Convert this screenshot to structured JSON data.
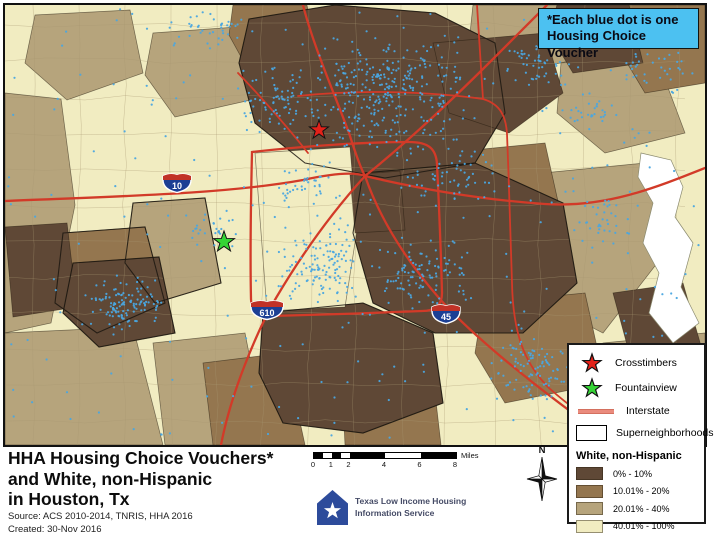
{
  "banner": {
    "line1": "*Each blue dot is one",
    "line2": "Housing Choice Voucher"
  },
  "title": {
    "line1": "HHA Housing Choice Vouchers*",
    "line2": "and White, non-Hispanic",
    "line3": "in Houston, Tx",
    "source": "Source: ACS 2010-2014, TNRIS, HHA 2016",
    "created": "Created: 30-Nov 2016"
  },
  "legend": {
    "items": [
      {
        "marker": "red-star",
        "label": "Crosstimbers"
      },
      {
        "marker": "green-star",
        "label": "Fountainview"
      },
      {
        "marker": "red-line",
        "label": "Interstate"
      },
      {
        "marker": "outline-box",
        "label": "Superneighborhoods"
      }
    ],
    "choropleth": {
      "header": "White, non-Hispanic",
      "classes": [
        {
          "label": "0% - 10%",
          "color": "#5f4836"
        },
        {
          "label": "10.01% - 20%",
          "color": "#94764f"
        },
        {
          "label": "20.01% - 40%",
          "color": "#b6a47c"
        },
        {
          "label": "40.01% - 100%",
          "color": "#f1ecc1"
        }
      ]
    }
  },
  "scalebar": {
    "ticks": [
      "0",
      "1",
      "2",
      "4",
      "6",
      "8"
    ],
    "unit": "Miles"
  },
  "north_arrow": {
    "label": "N"
  },
  "logo": {
    "line1": "Texas Low Income Housing",
    "line2": "Information Service"
  },
  "map": {
    "shields": [
      {
        "route": "10"
      },
      {
        "route": "610"
      },
      {
        "route": "45"
      }
    ],
    "markers": [
      {
        "name": "Crosstimbers",
        "color": "#e32119"
      },
      {
        "name": "Fountainview",
        "color": "#35d435"
      }
    ],
    "colors": {
      "dot_blue": "#4aa7e0",
      "interstate_red": "#d23a28",
      "banner_blue": "#4cc1f1",
      "water_white": "#ffffff"
    }
  }
}
